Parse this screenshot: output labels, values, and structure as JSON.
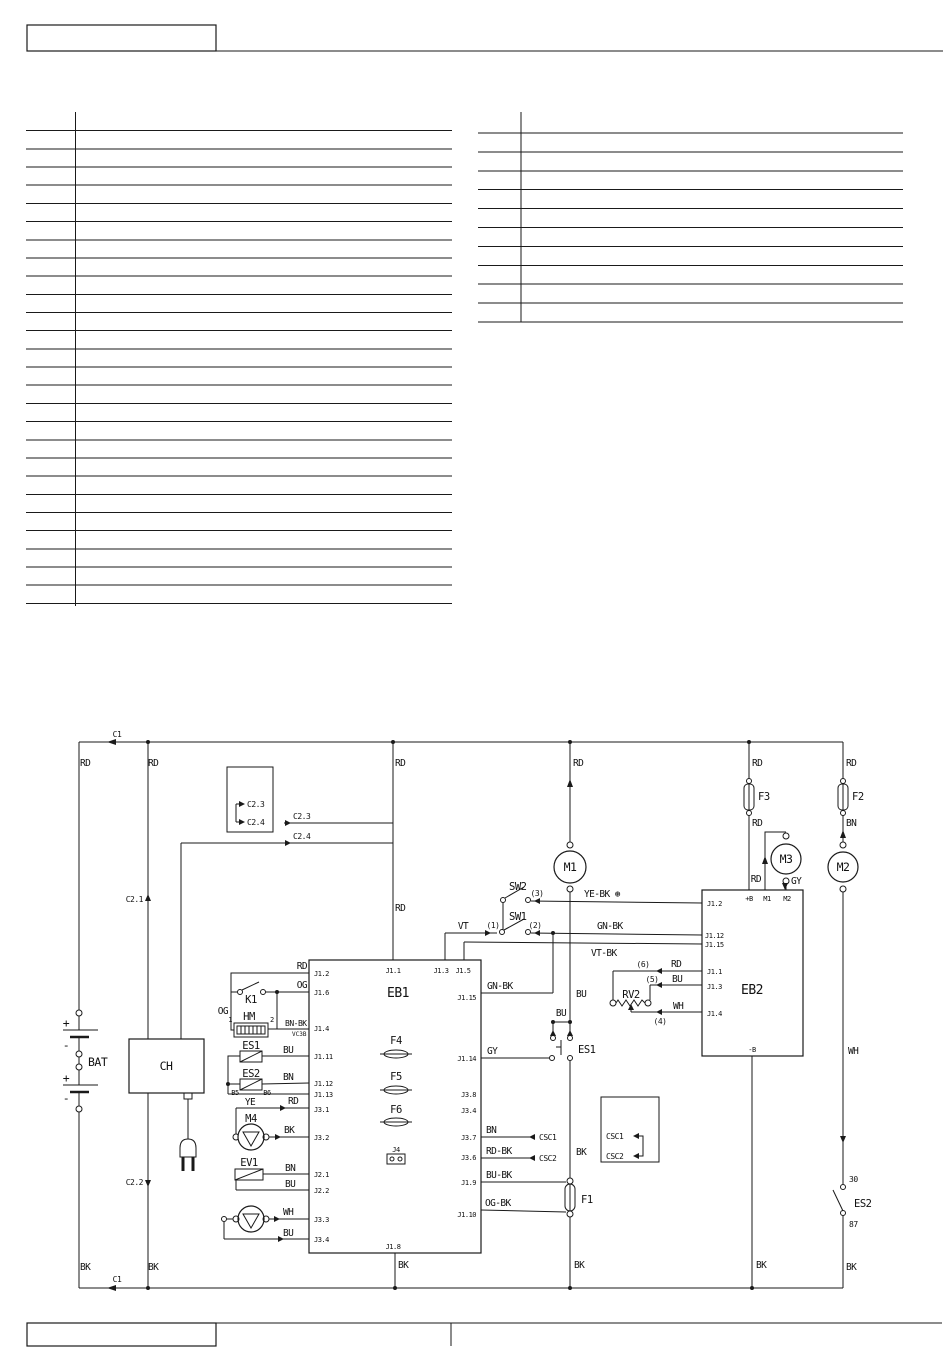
{
  "doc": {
    "type": "wiring-diagram-page",
    "line_color": "#1a1a1a",
    "background": "#ffffff"
  },
  "tables": {
    "left": {
      "rows": 27,
      "x1": 26,
      "x2": 452,
      "y0": 130.7,
      "dy": 18.18,
      "divider_x": 75.5,
      "divider_y1": 112,
      "divider_y2": 606
    },
    "right": {
      "rows": 11,
      "x1": 478,
      "x2": 903,
      "y0": 133,
      "dy": 18.9,
      "divider_x": 521,
      "divider_y1": 112,
      "divider_y2": 322
    }
  },
  "labels": {
    "c1": "C1",
    "c21": "C2.1",
    "c22": "C2.2",
    "c23": "C2.3",
    "c24": "C2.4",
    "rd": "RD",
    "bk": "BK",
    "bu": "BU",
    "bn": "BN",
    "ye": "YE",
    "gy": "GY",
    "wh": "WH",
    "vt": "VT",
    "og": "OG",
    "gnbk": "GN-BK",
    "yebk": "YE-BK ⊛",
    "vtbk": "VT-BK",
    "bnbk": "BN-BK",
    "rdbk": "RD-BK",
    "bubk": "BU-BK",
    "ogbk": "OG-BK",
    "bat": "BAT",
    "ch": "CH",
    "eb1": "EB1",
    "eb2": "EB2",
    "m1": "M1",
    "m2": "M2",
    "m3": "M3",
    "m4": "M4",
    "k1": "K1",
    "hm": "HM",
    "es1": "ES1",
    "es2": "ES2",
    "ev1": "EV1",
    "rv2": "RV2",
    "sw1": "SW1",
    "sw2": "SW2",
    "f1": "F1",
    "f2": "F2",
    "f3": "F3",
    "f4": "F4",
    "f5": "F5",
    "f6": "F6",
    "j4": "J4",
    "csc1": "CSC1",
    "csc2": "CSC2",
    "plus": "+",
    "minus": "-",
    "vc3b": "VC3B",
    "b5": "B5",
    "b6": "B6",
    "hm1": "1",
    "hm2": "2",
    "n1": "(1)",
    "n2": "(2)",
    "n3": "(3)",
    "n4": "(4)",
    "n5": "(5)",
    "n6": "(6)",
    "t30": "30",
    "t87": "87",
    "pb": "+B",
    "mb": "-B",
    "j1_1": "J1.1",
    "j1_2": "J1.2",
    "j1_3": "J1.3",
    "j1_4": "J1.4",
    "j1_5": "J1.5",
    "j1_6": "J1.6",
    "j1_8": "J1.8",
    "j1_9": "J1.9",
    "j1_10": "J1.10",
    "j1_11": "J1.11",
    "j1_12": "J1.12",
    "j1_13": "J1.13",
    "j1_14": "J1.14",
    "j1_15": "J1.15",
    "j2_1": "J2.1",
    "j2_2": "J2.2",
    "j3_1": "J3.1",
    "j3_2": "J3.2",
    "j3_3": "J3.3",
    "j3_4": "J3.4",
    "j3_6": "J3.6",
    "j3_7": "J3.7",
    "j3_8": "J3.8"
  }
}
